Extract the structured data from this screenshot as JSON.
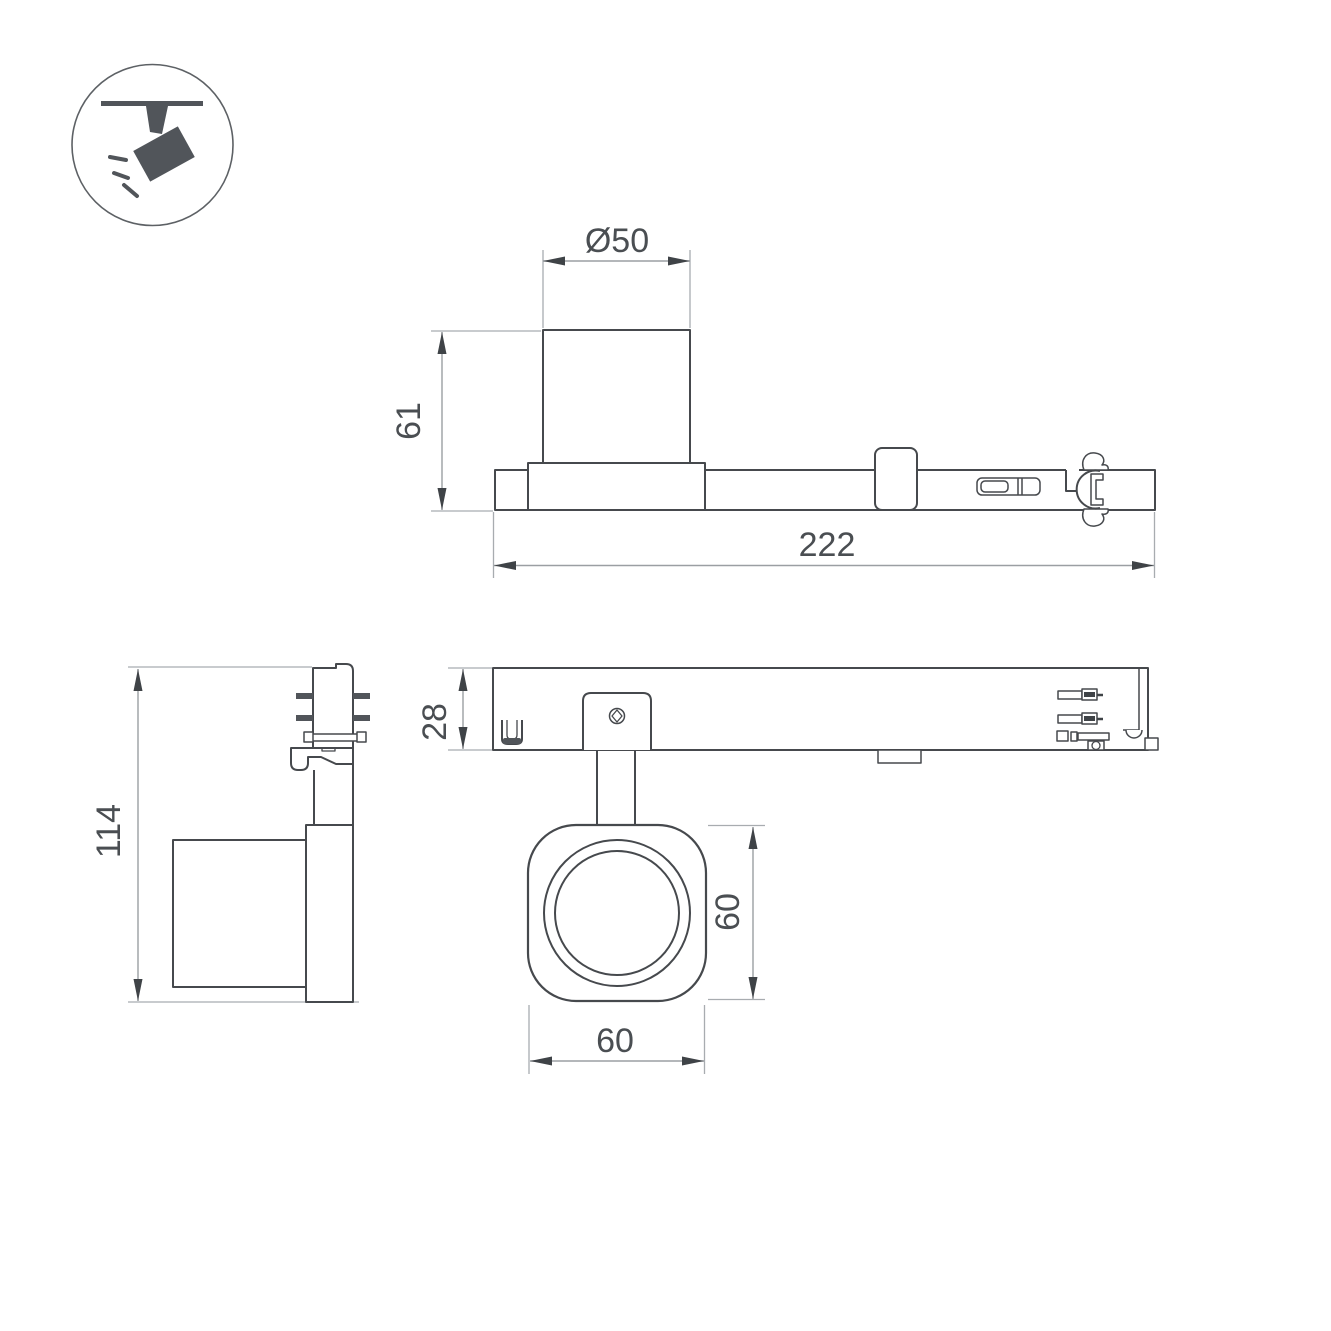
{
  "page": {
    "type": "technical dimension drawing",
    "subject": "track-mounted spotlight with track adapter, four orthographic views",
    "background": "#ffffff"
  },
  "colors": {
    "outline": "#46494d",
    "dimension_line": "#9b9fa3",
    "extension_line": "#a8acb0",
    "arrow": "#3f4347",
    "text": "#4a4e52",
    "icon_fill": "#51555a",
    "icon_circle": "#5d6165"
  },
  "icon": {
    "name": "track-spotlight-pictogram",
    "description": "ceiling track with angled spotlight emitting light rays"
  },
  "dimensions": {
    "head_diameter": "Ø50",
    "head_height": "61",
    "total_length": "222",
    "rail_height": "28",
    "total_height": "114",
    "lens_height": "60",
    "lens_width": "60"
  }
}
